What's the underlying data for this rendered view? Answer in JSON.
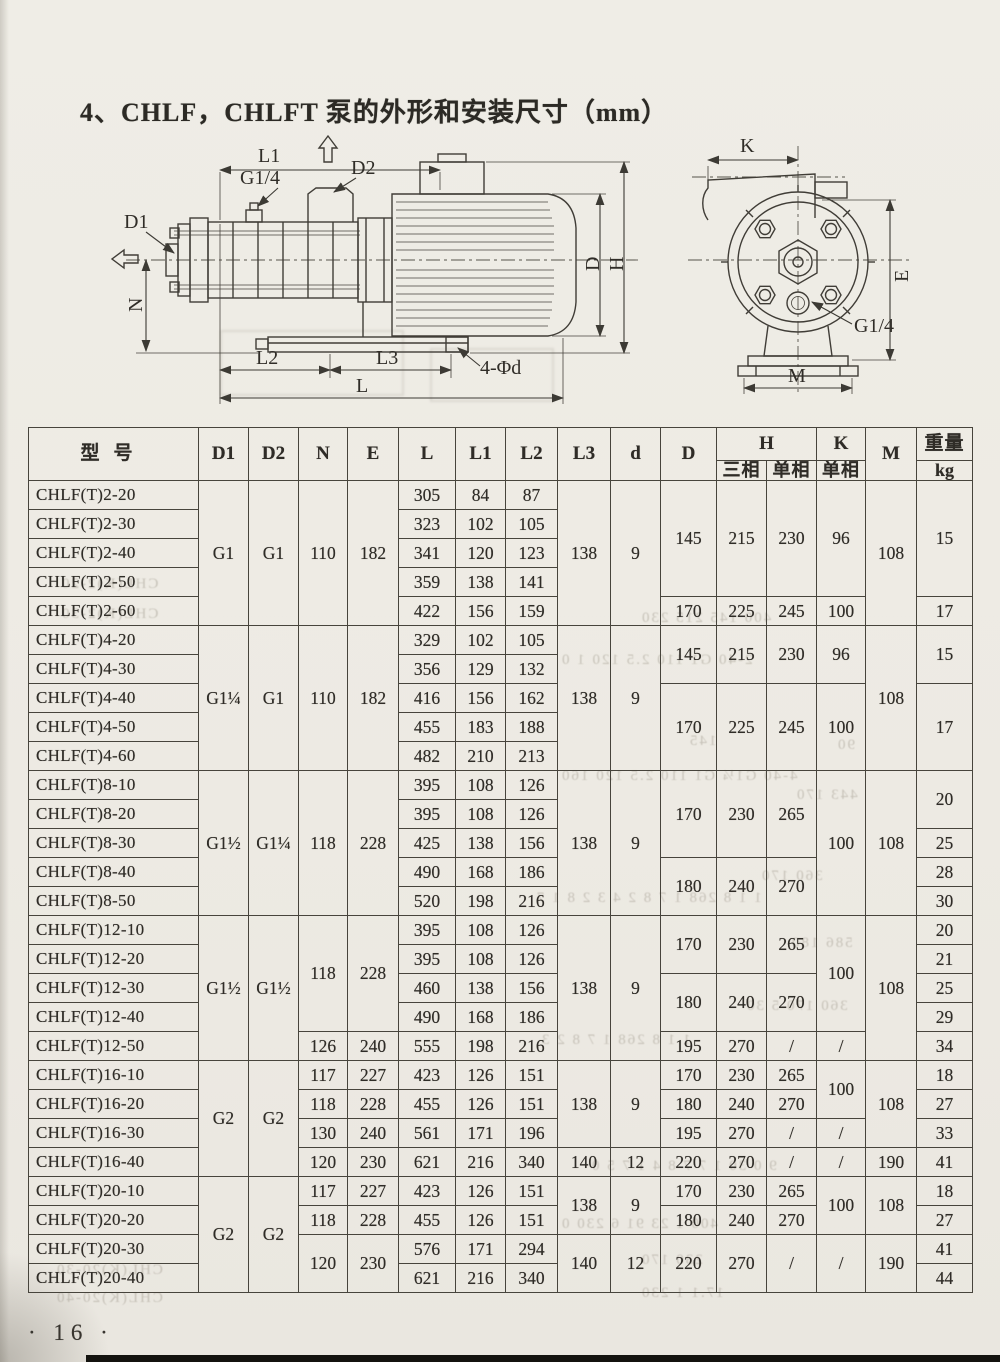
{
  "page": {
    "title": "4、CHLF，CHLFT 泵的外形和安装尺寸（mm）",
    "page_number": "· 16 ·"
  },
  "diagrams": {
    "side_view": {
      "labels": {
        "l1": "L1",
        "g14": "G1/4",
        "d2": "D2",
        "d1": "D1",
        "n": "N",
        "l2": "L2",
        "l3": "L3",
        "l": "L",
        "phid": "4-Φd",
        "d": "D",
        "h": "H"
      }
    },
    "end_view": {
      "labels": {
        "k": "K",
        "e": "E",
        "g14": "G1/4",
        "m": "M"
      }
    }
  },
  "table": {
    "header": {
      "model": "型号",
      "dims": [
        "D1",
        "D2",
        "N",
        "E",
        "L",
        "L1",
        "L2",
        "L3",
        "d",
        "D"
      ],
      "h_label": "H",
      "h_sub": [
        "三相",
        "单相"
      ],
      "k_label": "K",
      "k_sub": "单相",
      "m_label": "M",
      "weight_label": "重量",
      "weight_unit": "kg"
    },
    "rows": [
      [
        {
          "t": "CHLF(T)2-20",
          "m": 1
        },
        {
          "t": "G1",
          "r": 5
        },
        {
          "t": "G1",
          "r": 5
        },
        {
          "t": "110",
          "r": 5
        },
        {
          "t": "182",
          "r": 5
        },
        {
          "t": "305"
        },
        {
          "t": "84"
        },
        {
          "t": "87"
        },
        {
          "t": "138",
          "r": 5
        },
        {
          "t": "9",
          "r": 5
        },
        {
          "t": "145",
          "r": 4
        },
        {
          "t": "215",
          "r": 4
        },
        {
          "t": "230",
          "r": 4
        },
        {
          "t": "96",
          "r": 4
        },
        {
          "t": "108",
          "r": 5
        },
        {
          "t": "15",
          "r": 4
        }
      ],
      [
        {
          "t": "CHLF(T)2-30",
          "m": 1
        },
        {
          "t": "323"
        },
        {
          "t": "102"
        },
        {
          "t": "105"
        }
      ],
      [
        {
          "t": "CHLF(T)2-40",
          "m": 1
        },
        {
          "t": "341"
        },
        {
          "t": "120"
        },
        {
          "t": "123"
        }
      ],
      [
        {
          "t": "CHLF(T)2-50",
          "m": 1
        },
        {
          "t": "359"
        },
        {
          "t": "138"
        },
        {
          "t": "141"
        }
      ],
      [
        {
          "t": "CHLF(T)2-60",
          "m": 1
        },
        {
          "t": "422"
        },
        {
          "t": "156"
        },
        {
          "t": "159"
        },
        {
          "t": "170"
        },
        {
          "t": "225"
        },
        {
          "t": "245"
        },
        {
          "t": "100"
        },
        {
          "t": "17"
        }
      ],
      [
        {
          "t": "CHLF(T)4-20",
          "m": 1
        },
        {
          "t": "G1¼",
          "r": 5
        },
        {
          "t": "G1",
          "r": 5
        },
        {
          "t": "110",
          "r": 5
        },
        {
          "t": "182",
          "r": 5
        },
        {
          "t": "329"
        },
        {
          "t": "102"
        },
        {
          "t": "105"
        },
        {
          "t": "138",
          "r": 5
        },
        {
          "t": "9",
          "r": 5
        },
        {
          "t": "145",
          "r": 2
        },
        {
          "t": "215",
          "r": 2
        },
        {
          "t": "230",
          "r": 2
        },
        {
          "t": "96",
          "r": 2
        },
        {
          "t": "108",
          "r": 5
        },
        {
          "t": "15",
          "r": 2
        }
      ],
      [
        {
          "t": "CHLF(T)4-30",
          "m": 1
        },
        {
          "t": "356"
        },
        {
          "t": "129"
        },
        {
          "t": "132"
        }
      ],
      [
        {
          "t": "CHLF(T)4-40",
          "m": 1
        },
        {
          "t": "416"
        },
        {
          "t": "156"
        },
        {
          "t": "162"
        },
        {
          "t": "170",
          "r": 3
        },
        {
          "t": "225",
          "r": 3
        },
        {
          "t": "245",
          "r": 3
        },
        {
          "t": "100",
          "r": 3
        },
        {
          "t": "17",
          "r": 3
        }
      ],
      [
        {
          "t": "CHLF(T)4-50",
          "m": 1
        },
        {
          "t": "455"
        },
        {
          "t": "183"
        },
        {
          "t": "188"
        }
      ],
      [
        {
          "t": "CHLF(T)4-60",
          "m": 1
        },
        {
          "t": "482"
        },
        {
          "t": "210"
        },
        {
          "t": "213"
        }
      ],
      [
        {
          "t": "CHLF(T)8-10",
          "m": 1
        },
        {
          "t": "G1½",
          "r": 5
        },
        {
          "t": "G1¼",
          "r": 5
        },
        {
          "t": "118",
          "r": 5
        },
        {
          "t": "228",
          "r": 5
        },
        {
          "t": "395"
        },
        {
          "t": "108"
        },
        {
          "t": "126"
        },
        {
          "t": "138",
          "r": 5
        },
        {
          "t": "9",
          "r": 5
        },
        {
          "t": "170",
          "r": 3
        },
        {
          "t": "230",
          "r": 3
        },
        {
          "t": "265",
          "r": 3
        },
        {
          "t": "100",
          "r": 5
        },
        {
          "t": "108",
          "r": 5
        },
        {
          "t": "20",
          "r": 2
        }
      ],
      [
        {
          "t": "CHLF(T)8-20",
          "m": 1
        },
        {
          "t": "395"
        },
        {
          "t": "108"
        },
        {
          "t": "126"
        }
      ],
      [
        {
          "t": "CHLF(T)8-30",
          "m": 1
        },
        {
          "t": "425"
        },
        {
          "t": "138"
        },
        {
          "t": "156"
        },
        {
          "t": "25"
        }
      ],
      [
        {
          "t": "CHLF(T)8-40",
          "m": 1
        },
        {
          "t": "490"
        },
        {
          "t": "168"
        },
        {
          "t": "186"
        },
        {
          "t": "180",
          "r": 2
        },
        {
          "t": "240",
          "r": 2
        },
        {
          "t": "270",
          "r": 2
        },
        {
          "t": "28"
        }
      ],
      [
        {
          "t": "CHLF(T)8-50",
          "m": 1
        },
        {
          "t": "520"
        },
        {
          "t": "198"
        },
        {
          "t": "216"
        },
        {
          "t": "30"
        }
      ],
      [
        {
          "t": "CHLF(T)12-10",
          "m": 1
        },
        {
          "t": "G1½",
          "r": 5
        },
        {
          "t": "G1½",
          "r": 5
        },
        {
          "t": "118",
          "r": 4
        },
        {
          "t": "228",
          "r": 4
        },
        {
          "t": "395"
        },
        {
          "t": "108"
        },
        {
          "t": "126"
        },
        {
          "t": "138",
          "r": 5
        },
        {
          "t": "9",
          "r": 5
        },
        {
          "t": "170",
          "r": 2
        },
        {
          "t": "230",
          "r": 2
        },
        {
          "t": "265",
          "r": 2
        },
        {
          "t": "100",
          "r": 4
        },
        {
          "t": "108",
          "r": 5
        },
        {
          "t": "20"
        }
      ],
      [
        {
          "t": "CHLF(T)12-20",
          "m": 1
        },
        {
          "t": "395"
        },
        {
          "t": "108"
        },
        {
          "t": "126"
        },
        {
          "t": "21"
        }
      ],
      [
        {
          "t": "CHLF(T)12-30",
          "m": 1
        },
        {
          "t": "460"
        },
        {
          "t": "138"
        },
        {
          "t": "156"
        },
        {
          "t": "180",
          "r": 2
        },
        {
          "t": "240",
          "r": 2
        },
        {
          "t": "270",
          "r": 2
        },
        {
          "t": "25"
        }
      ],
      [
        {
          "t": "CHLF(T)12-40",
          "m": 1
        },
        {
          "t": "490"
        },
        {
          "t": "168"
        },
        {
          "t": "186"
        },
        {
          "t": "29"
        }
      ],
      [
        {
          "t": "CHLF(T)12-50",
          "m": 1
        },
        {
          "t": "126"
        },
        {
          "t": "240"
        },
        {
          "t": "555"
        },
        {
          "t": "198"
        },
        {
          "t": "216"
        },
        {
          "t": "195"
        },
        {
          "t": "270"
        },
        {
          "t": "/"
        },
        {
          "t": "/"
        },
        {
          "t": "34"
        }
      ],
      [
        {
          "t": "CHLF(T)16-10",
          "m": 1
        },
        {
          "t": "G2",
          "r": 4
        },
        {
          "t": "G2",
          "r": 4
        },
        {
          "t": "117"
        },
        {
          "t": "227"
        },
        {
          "t": "423"
        },
        {
          "t": "126"
        },
        {
          "t": "151"
        },
        {
          "t": "138",
          "r": 3
        },
        {
          "t": "9",
          "r": 3
        },
        {
          "t": "170"
        },
        {
          "t": "230"
        },
        {
          "t": "265"
        },
        {
          "t": "100",
          "r": 2
        },
        {
          "t": "108",
          "r": 3
        },
        {
          "t": "18"
        }
      ],
      [
        {
          "t": "CHLF(T)16-20",
          "m": 1
        },
        {
          "t": "118"
        },
        {
          "t": "228"
        },
        {
          "t": "455"
        },
        {
          "t": "126"
        },
        {
          "t": "151"
        },
        {
          "t": "180"
        },
        {
          "t": "240"
        },
        {
          "t": "270"
        },
        {
          "t": "27"
        }
      ],
      [
        {
          "t": "CHLF(T)16-30",
          "m": 1
        },
        {
          "t": "130"
        },
        {
          "t": "240"
        },
        {
          "t": "561"
        },
        {
          "t": "171"
        },
        {
          "t": "196"
        },
        {
          "t": "195"
        },
        {
          "t": "270"
        },
        {
          "t": "/"
        },
        {
          "t": "/"
        },
        {
          "t": "33"
        }
      ],
      [
        {
          "t": "CHLF(T)16-40",
          "m": 1
        },
        {
          "t": "120"
        },
        {
          "t": "230"
        },
        {
          "t": "621"
        },
        {
          "t": "216"
        },
        {
          "t": "340"
        },
        {
          "t": "140"
        },
        {
          "t": "12"
        },
        {
          "t": "220"
        },
        {
          "t": "270"
        },
        {
          "t": "/"
        },
        {
          "t": "/"
        },
        {
          "t": "190"
        },
        {
          "t": "41"
        }
      ],
      [
        {
          "t": "CHLF(T)20-10",
          "m": 1
        },
        {
          "t": "G2",
          "r": 4
        },
        {
          "t": "G2",
          "r": 4
        },
        {
          "t": "117"
        },
        {
          "t": "227"
        },
        {
          "t": "423"
        },
        {
          "t": "126"
        },
        {
          "t": "151"
        },
        {
          "t": "138",
          "r": 2
        },
        {
          "t": "9",
          "r": 2
        },
        {
          "t": "170"
        },
        {
          "t": "230"
        },
        {
          "t": "265"
        },
        {
          "t": "100",
          "r": 2
        },
        {
          "t": "108",
          "r": 2
        },
        {
          "t": "18"
        }
      ],
      [
        {
          "t": "CHLF(T)20-20",
          "m": 1
        },
        {
          "t": "118"
        },
        {
          "t": "228"
        },
        {
          "t": "455"
        },
        {
          "t": "126"
        },
        {
          "t": "151"
        },
        {
          "t": "180"
        },
        {
          "t": "240"
        },
        {
          "t": "270"
        },
        {
          "t": "27"
        }
      ],
      [
        {
          "t": "CHLF(T)20-30",
          "m": 1
        },
        {
          "t": "120",
          "r": 2
        },
        {
          "t": "230",
          "r": 2
        },
        {
          "t": "576"
        },
        {
          "t": "171"
        },
        {
          "t": "294"
        },
        {
          "t": "140",
          "r": 2
        },
        {
          "t": "12",
          "r": 2
        },
        {
          "t": "220",
          "r": 2
        },
        {
          "t": "270",
          "r": 2
        },
        {
          "t": "/",
          "r": 2
        },
        {
          "t": "/",
          "r": 2
        },
        {
          "t": "190",
          "r": 2
        },
        {
          "t": "41"
        }
      ],
      [
        {
          "t": "CHLF(T)20-40",
          "m": 1
        },
        {
          "t": "621"
        },
        {
          "t": "216"
        },
        {
          "t": "340"
        },
        {
          "t": "44"
        }
      ]
    ]
  },
  "ghost_text": [
    {
      "x": 60,
      "y": 576,
      "t": "CHL(K)2-20"
    },
    {
      "x": 60,
      "y": 606,
      "t": "CHL(K)2-30"
    },
    {
      "x": 640,
      "y": 610,
      "t": "400 145 215 230"
    },
    {
      "x": 560,
      "y": 652,
      "t": "2-40 G1 110 2.5 120 1 0"
    },
    {
      "x": 688,
      "y": 733,
      "t": "145"
    },
    {
      "x": 836,
      "y": 737,
      "t": "90"
    },
    {
      "x": 560,
      "y": 768,
      "t": "4-40 G1¼ G1 110 2.5 120 160"
    },
    {
      "x": 795,
      "y": 787,
      "t": "443 170"
    },
    {
      "x": 760,
      "y": 868,
      "t": "360 170"
    },
    {
      "x": 535,
      "y": 890,
      "t": "1 1 8 268 1 7 8 2 4 3 2 8 1 7"
    },
    {
      "x": 790,
      "y": 935,
      "t": "586 180"
    },
    {
      "x": 745,
      "y": 998,
      "t": "360 170 5 30"
    },
    {
      "x": 540,
      "y": 1032,
      "t": "1 1 8 268 1 7 8 2 3"
    },
    {
      "x": 590,
      "y": 1158,
      "t": "9 0 30 1 7 7 8 4 1 7 5 0"
    },
    {
      "x": 560,
      "y": 1216,
      "t": "400 1 23 91 6 230 0"
    },
    {
      "x": 640,
      "y": 1252,
      "t": "230 170"
    },
    {
      "x": 55,
      "y": 1262,
      "t": "CHL(K)20-30"
    },
    {
      "x": 640,
      "y": 1285,
      "t": "17.1 1 230"
    },
    {
      "x": 55,
      "y": 1290,
      "t": "CHL(K)20-40"
    }
  ]
}
